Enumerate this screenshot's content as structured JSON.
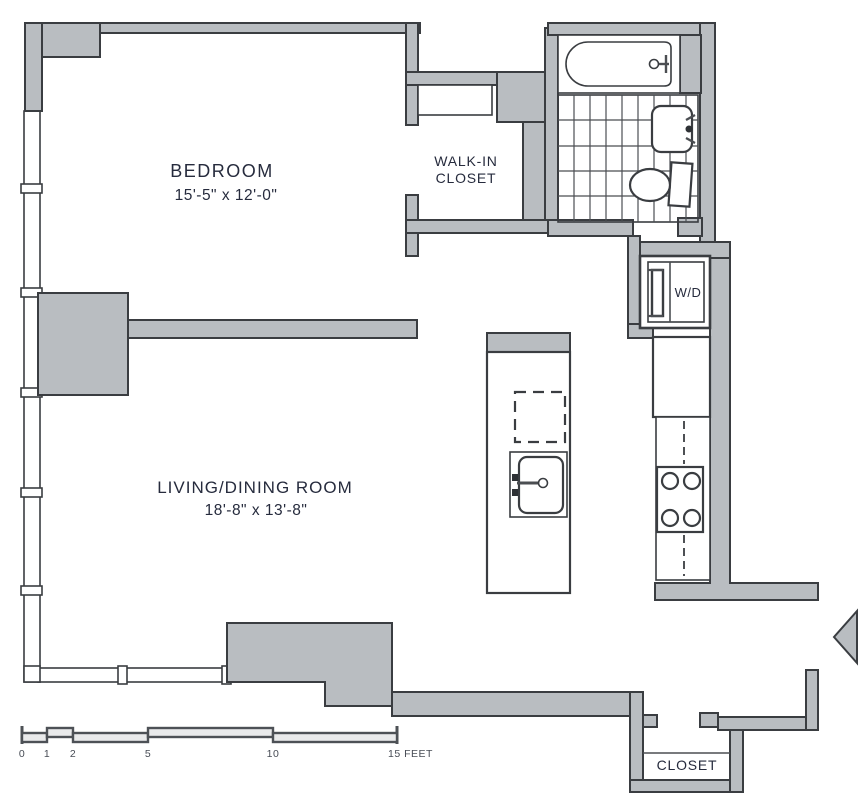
{
  "plan": {
    "type": "apartment-floor-plan",
    "rooms": {
      "bedroom": {
        "name": "BEDROOM",
        "dimensions": "15'-5\" x 12'-0\""
      },
      "walk_in_closet": {
        "name_line1": "WALK-IN",
        "name_line2": "CLOSET"
      },
      "living_dining_room": {
        "name": "LIVING/DINING ROOM",
        "dimensions": "18'-8\" x 13'-8\""
      },
      "washer_dryer": {
        "label": "W/D"
      },
      "entry_closet": {
        "label": "CLOSET"
      }
    },
    "fixtures": [
      "bathtub-icon",
      "bathroom-sink-icon",
      "toilet-icon",
      "tile-floor-pattern",
      "washer-dryer-icon",
      "refrigerator-icon",
      "kitchen-counter",
      "stove-burners-icon",
      "dishwasher-dashed-icon",
      "kitchen-sink-icon",
      "entry-door-swing-icon",
      "window-wall",
      "closet-shelf"
    ],
    "scale_bar": {
      "unit_labels": [
        "0",
        "1",
        "2",
        "5",
        "10"
      ],
      "end_label": "15 FEET"
    },
    "colors": {
      "wall_fill": "#b9bdc1",
      "wall_line": "#3a3d41",
      "text": "#262b3d",
      "scale_line": "#4d5156",
      "background": "#ffffff"
    }
  }
}
